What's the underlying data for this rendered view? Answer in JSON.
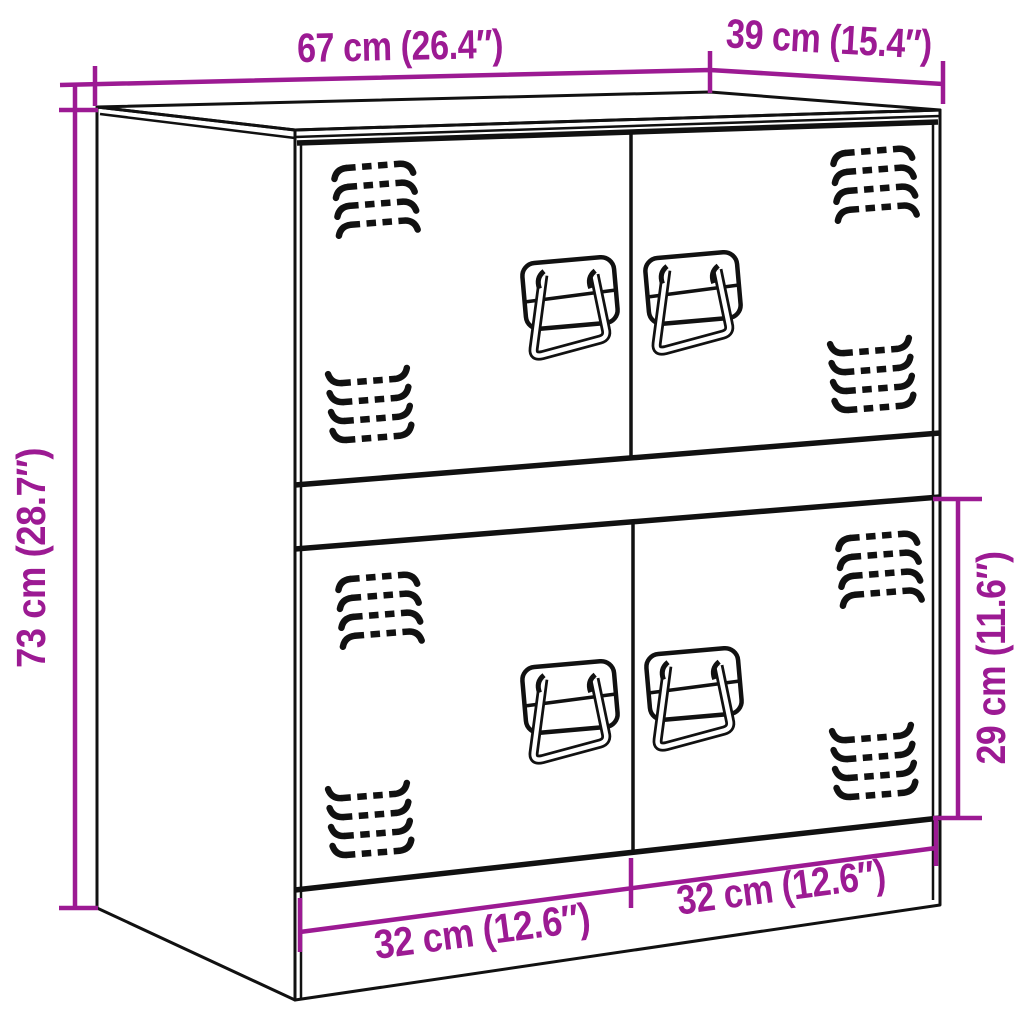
{
  "title": "Cabinet dimensions line drawing",
  "colors": {
    "background": "#ffffff",
    "line": "#111111",
    "dimension": "#9c1a93"
  },
  "dimensions": {
    "width_label": "67 cm (26.4″)",
    "depth_label": "39 cm (15.4″)",
    "height_label": "73 cm (28.7″)",
    "door_height_label": "29 cm (11.6″)",
    "door_width_left_label": "32 cm (12.6″)",
    "door_width_right_label": "32 cm (12.6″)"
  }
}
